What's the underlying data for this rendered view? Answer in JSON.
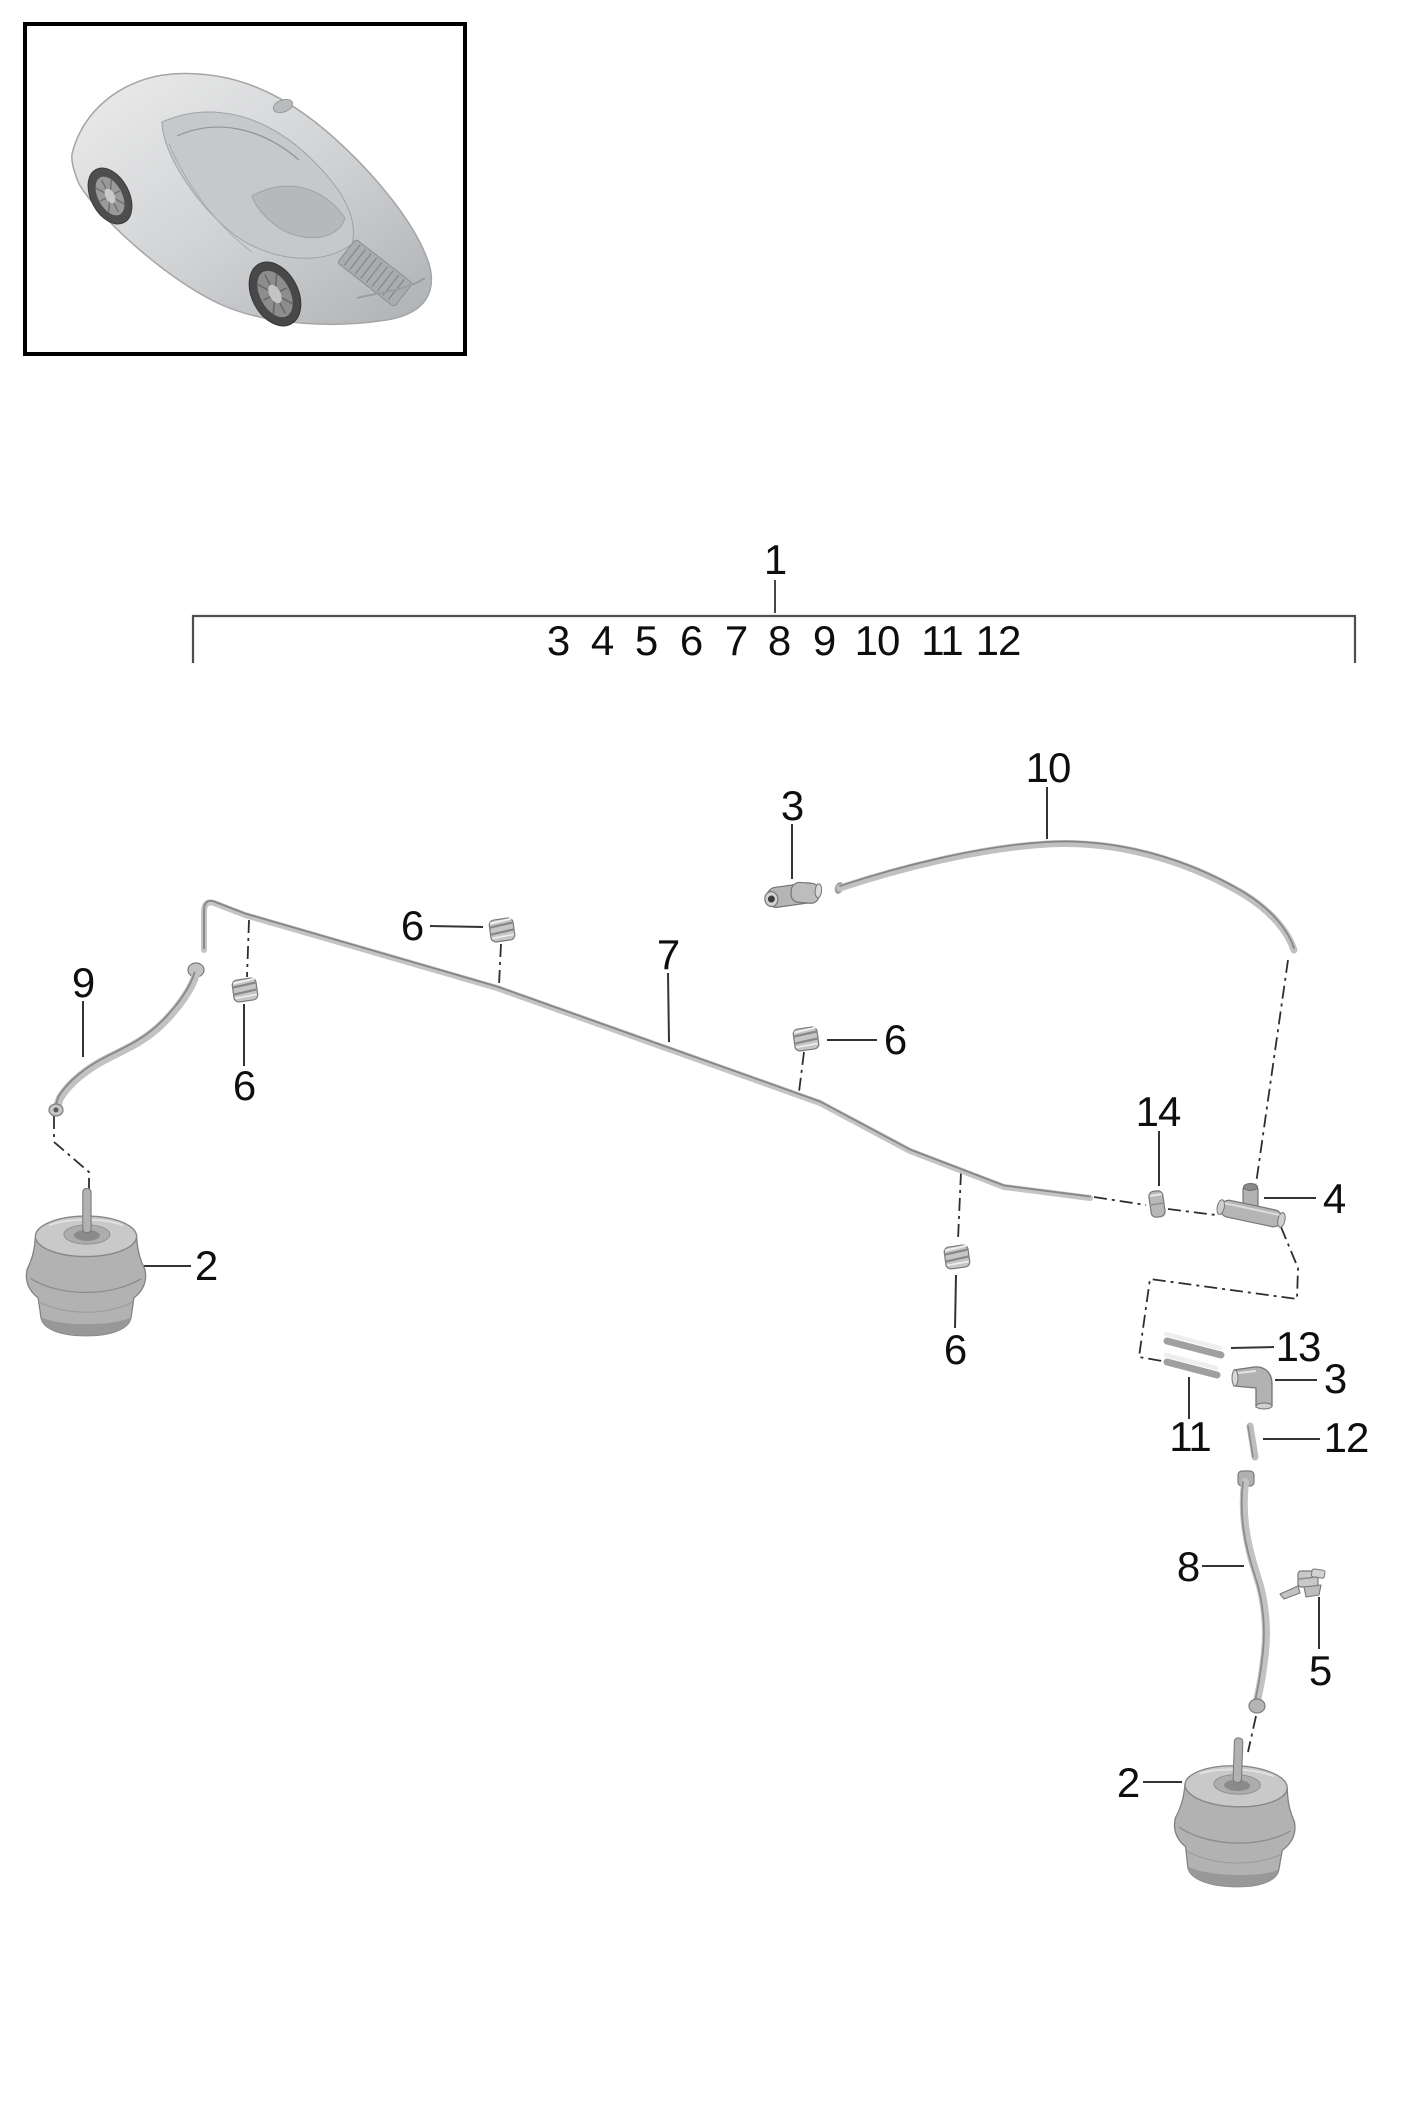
{
  "bracket": {
    "group_label": "1",
    "numbers": [
      {
        "t": "3",
        "x": 558,
        "y": 641
      },
      {
        "t": "4",
        "x": 602,
        "y": 641
      },
      {
        "t": "5",
        "x": 646,
        "y": 641
      },
      {
        "t": "6",
        "x": 691,
        "y": 641
      },
      {
        "t": "7",
        "x": 736,
        "y": 641
      },
      {
        "t": "8",
        "x": 779,
        "y": 641
      },
      {
        "t": "9",
        "x": 824,
        "y": 641
      },
      {
        "t": "10",
        "x": 877,
        "y": 641
      },
      {
        "t": "11",
        "x": 942,
        "y": 641
      },
      {
        "t": "12",
        "x": 998,
        "y": 641
      }
    ]
  },
  "callouts": [
    {
      "t": "10",
      "x": 1048,
      "y": 768
    },
    {
      "t": "3",
      "x": 792,
      "y": 806
    },
    {
      "t": "6",
      "x": 412,
      "y": 926
    },
    {
      "t": "7",
      "x": 668,
      "y": 955
    },
    {
      "t": "9",
      "x": 83,
      "y": 983
    },
    {
      "t": "6",
      "x": 895,
      "y": 1040
    },
    {
      "t": "6",
      "x": 244,
      "y": 1086
    },
    {
      "t": "14",
      "x": 1158,
      "y": 1112
    },
    {
      "t": "4",
      "x": 1334,
      "y": 1199
    },
    {
      "t": "2",
      "x": 206,
      "y": 1266
    },
    {
      "t": "13",
      "x": 1298,
      "y": 1347
    },
    {
      "t": "6",
      "x": 955,
      "y": 1350
    },
    {
      "t": "3",
      "x": 1335,
      "y": 1379
    },
    {
      "t": "11",
      "x": 1190,
      "y": 1437
    },
    {
      "t": "12",
      "x": 1346,
      "y": 1438
    },
    {
      "t": "8",
      "x": 1188,
      "y": 1567
    },
    {
      "t": "5",
      "x": 1320,
      "y": 1671
    },
    {
      "t": "2",
      "x": 1128,
      "y": 1783
    }
  ],
  "colors": {
    "background": "#ffffff",
    "label": "#0e0e0e",
    "tube_light": "#c6c6c6",
    "tube_edge": "#8a8a8a",
    "leader": "#333333",
    "guide": "#2e2e2e"
  }
}
